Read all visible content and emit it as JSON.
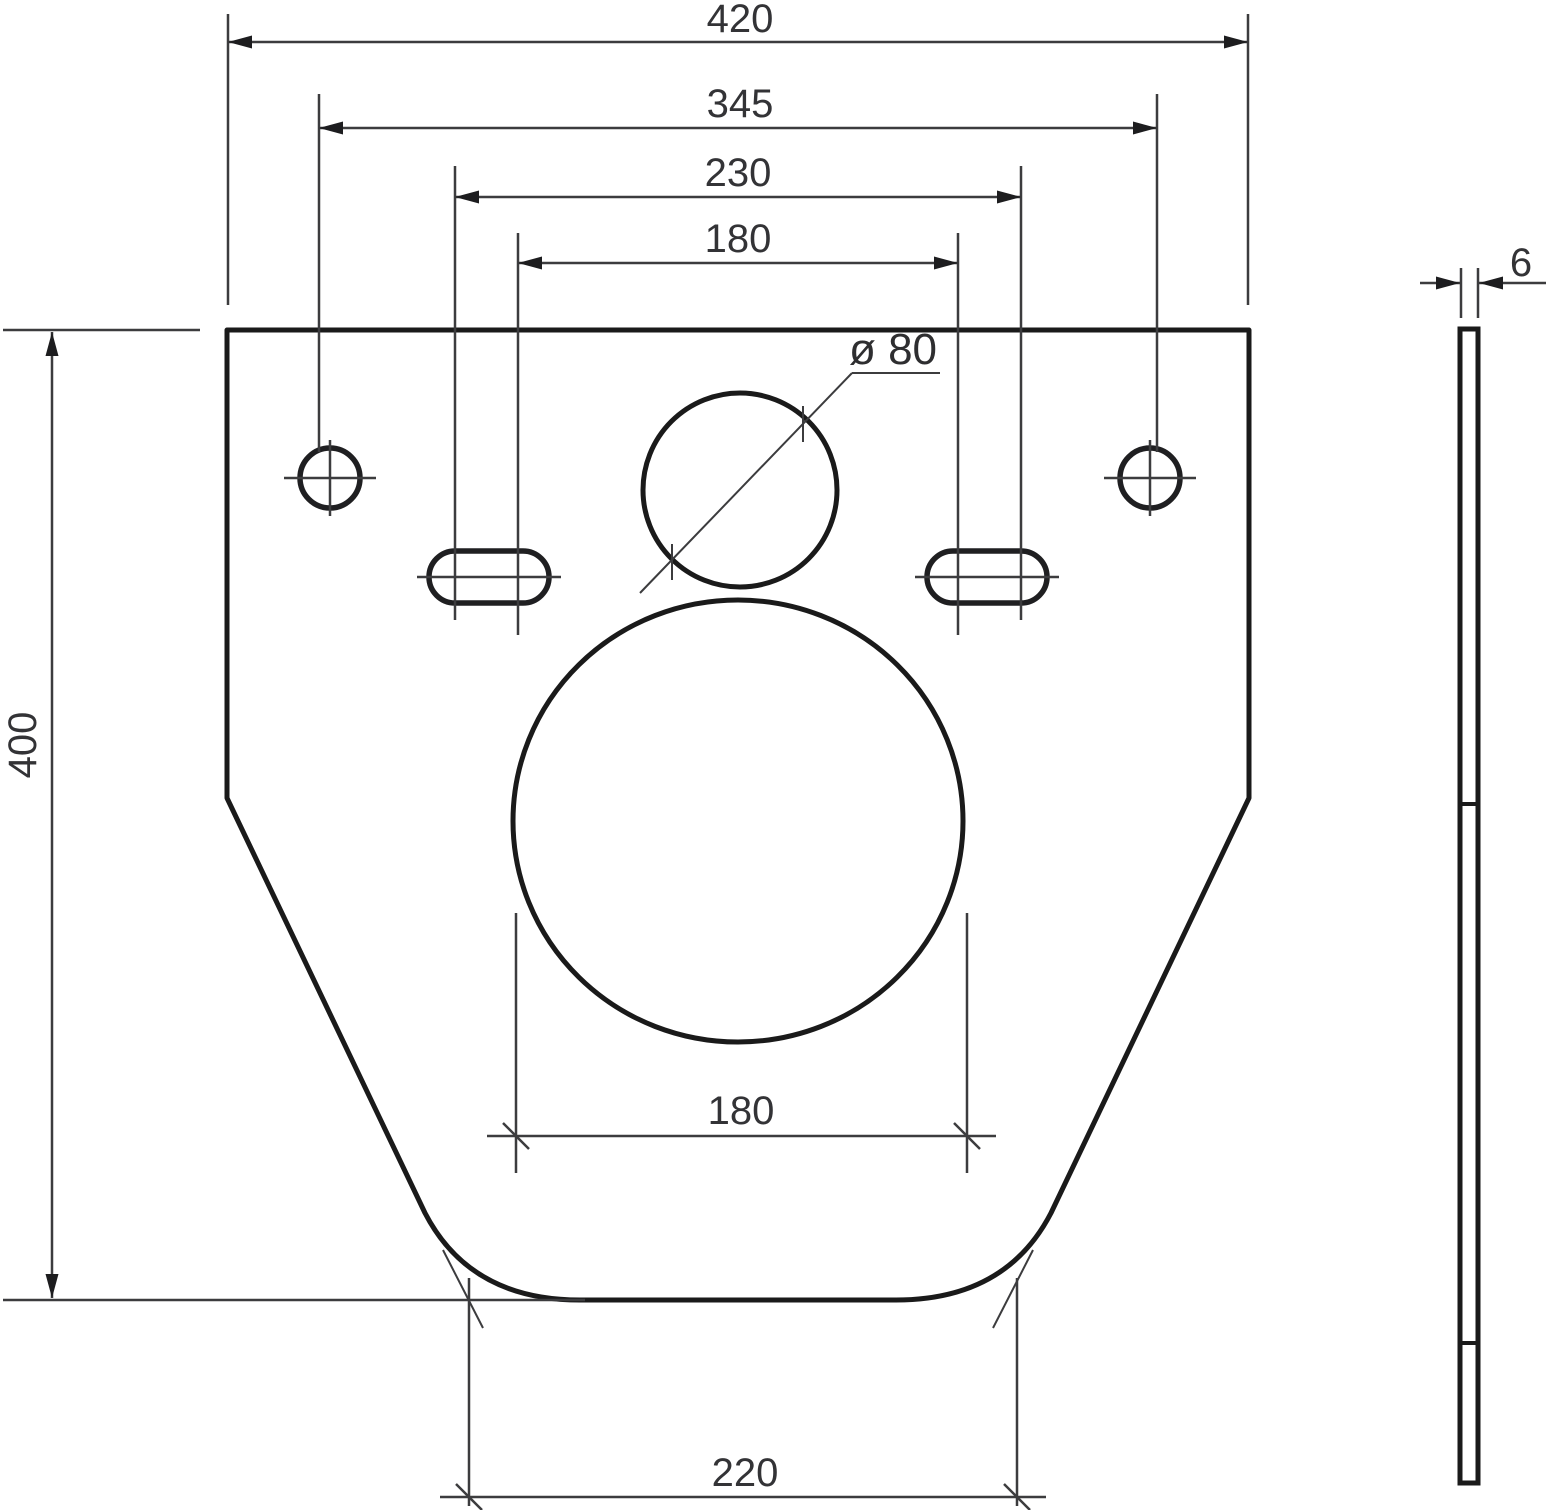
{
  "drawing": {
    "kind": "technical-dimension-drawing",
    "subject": "flat mounting / sound-insulation plate, front view and side view",
    "units": "mm",
    "front_view": {
      "dims": {
        "overall_width": "420",
        "hole_spacing": "345",
        "slot_spacing_outer": "230",
        "slot_spacing_inner": "180",
        "overall_height": "400",
        "outlet_width": "180",
        "bottom_width": "220",
        "pipe_hole_diameter": "ø 80"
      }
    },
    "side_view": {
      "dims": {
        "thickness": "6"
      }
    },
    "colors": {
      "background": "#ffffff",
      "outline": "#1a1a1a",
      "thin_line": "#3c3c3e",
      "text": "#333336"
    }
  }
}
